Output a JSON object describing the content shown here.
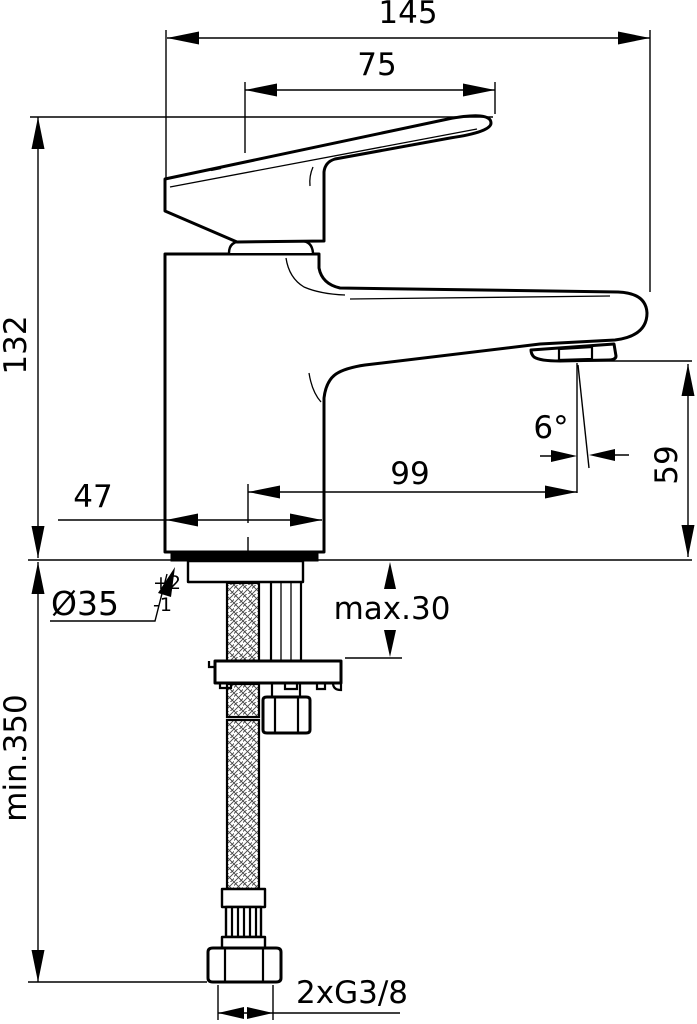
{
  "drawing": {
    "title": "Single-lever basin mixer faucet - dimensional side view with mounting hardware",
    "units": "mm",
    "labels": {
      "overall_length": "145",
      "handle_projection": "75",
      "total_height": "132",
      "base_depth": "47",
      "spout_reach": "99",
      "spout_angle": "6°",
      "spout_height": "59",
      "hole_diameter": "Ø35",
      "hole_tolerance_upper": "+2",
      "hole_tolerance_lower": "-1",
      "max_mounting_thickness": "max.30",
      "min_hose_length": "min.350",
      "supply_connection": "2xG3/8"
    },
    "colors": {
      "line": "#000000",
      "background": "#ffffff"
    }
  }
}
